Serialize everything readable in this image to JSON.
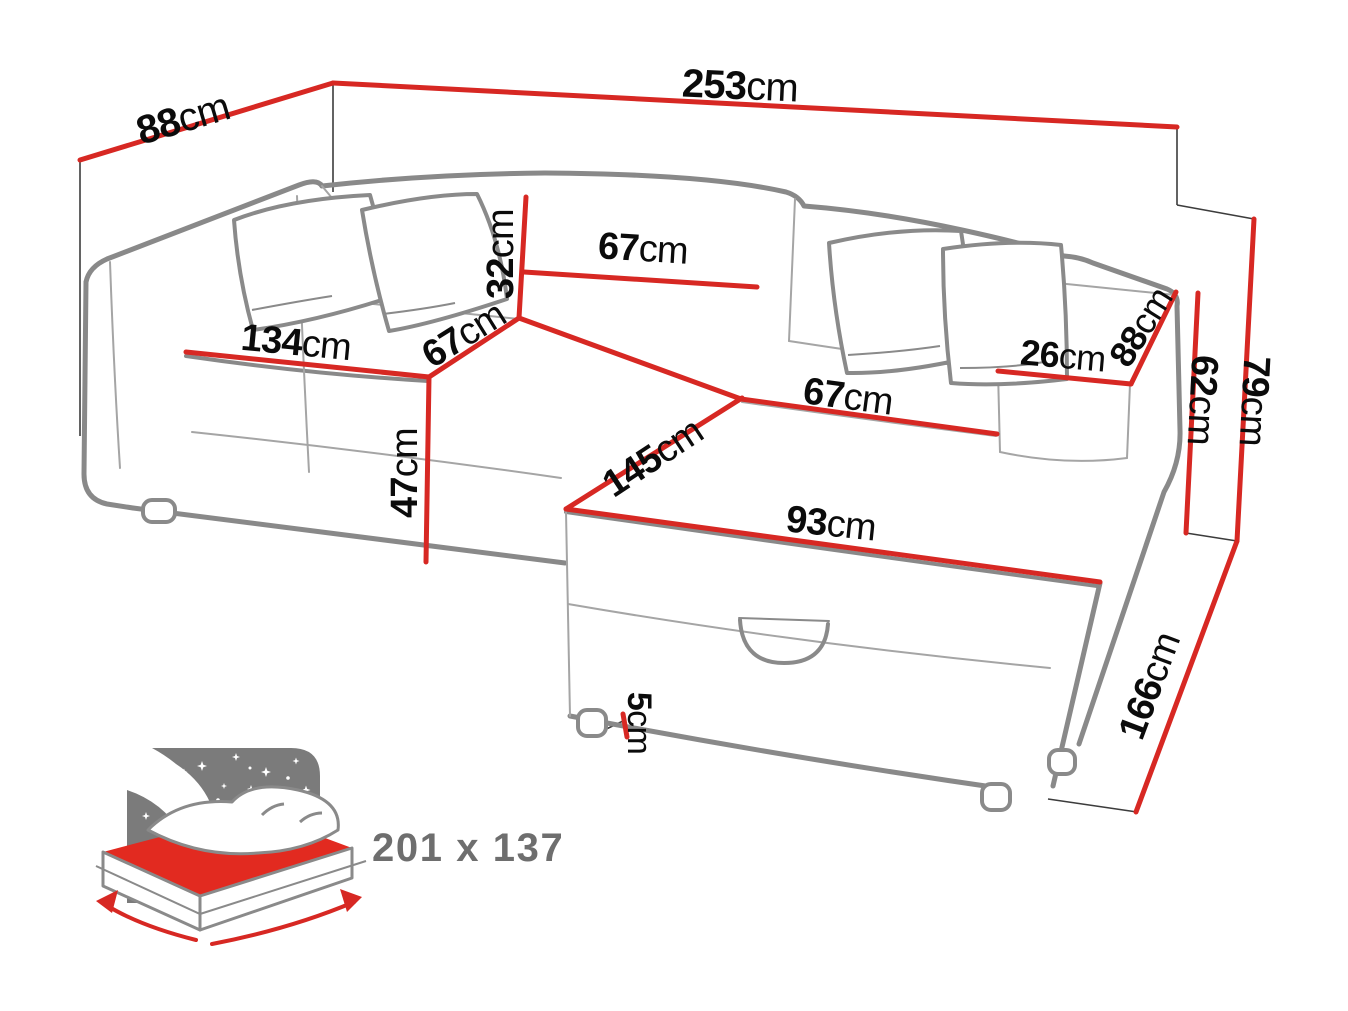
{
  "title": "Corner sofa bed dimension diagram",
  "colors": {
    "dimension_line": "#d72823",
    "sofa_outline": "#898989",
    "label_text": "#0b0b0b",
    "icon_gray": "#7b7b7b",
    "mattress_red": "#e22a20",
    "bed_size_text": "#6e6e6e"
  },
  "dimensions": [
    {
      "id": "total-width",
      "value": "253",
      "unit": "cm",
      "x": 740,
      "y": 86,
      "rot": 2.5,
      "size": 40
    },
    {
      "id": "back-depth-left",
      "value": "88",
      "unit": "cm",
      "x": 183,
      "y": 119,
      "rot": -16.5,
      "size": 40
    },
    {
      "id": "backrest-height",
      "value": "32",
      "unit": "cm",
      "x": 501,
      "y": 254,
      "rot": -90,
      "size": 38
    },
    {
      "id": "backrest-width",
      "value": "67",
      "unit": "cm",
      "x": 643,
      "y": 249,
      "rot": 3.5,
      "size": 38
    },
    {
      "id": "seat-width",
      "value": "134",
      "unit": "cm",
      "x": 296,
      "y": 343,
      "rot": 5.5,
      "size": 38
    },
    {
      "id": "seat-depth",
      "value": "67",
      "unit": "cm",
      "x": 464,
      "y": 335,
      "rot": -32,
      "size": 38
    },
    {
      "id": "chaise-seat-width",
      "value": "67",
      "unit": "cm",
      "x": 848,
      "y": 397,
      "rot": 7.5,
      "size": 38
    },
    {
      "id": "armrest-width",
      "value": "26",
      "unit": "cm",
      "x": 1063,
      "y": 356,
      "rot": 5,
      "size": 36
    },
    {
      "id": "armrest-depth",
      "value": "88",
      "unit": "cm",
      "x": 1141,
      "y": 327,
      "rot": -58,
      "size": 36
    },
    {
      "id": "armrest-height",
      "value": "62",
      "unit": "cm",
      "x": 1202,
      "y": 400,
      "rot": 93,
      "size": 38
    },
    {
      "id": "total-height",
      "value": "79",
      "unit": "cm",
      "x": 1254,
      "y": 401,
      "rot": 93,
      "size": 38
    },
    {
      "id": "seat-height",
      "value": "47",
      "unit": "cm",
      "x": 405,
      "y": 473,
      "rot": -90,
      "size": 38
    },
    {
      "id": "chaise-length",
      "value": "145",
      "unit": "cm",
      "x": 653,
      "y": 458,
      "rot": -33.5,
      "size": 38
    },
    {
      "id": "ottoman-width",
      "value": "93",
      "unit": "cm",
      "x": 831,
      "y": 524,
      "rot": 6,
      "size": 38
    },
    {
      "id": "leg-height",
      "value": "5",
      "unit": "cm",
      "x": 639,
      "y": 723,
      "rot": 90,
      "size": 34
    },
    {
      "id": "side-depth",
      "value": "166",
      "unit": "cm",
      "x": 1150,
      "y": 686,
      "rot": -69.5,
      "size": 38
    }
  ],
  "sleeping_area": {
    "label": "201 x 137"
  }
}
